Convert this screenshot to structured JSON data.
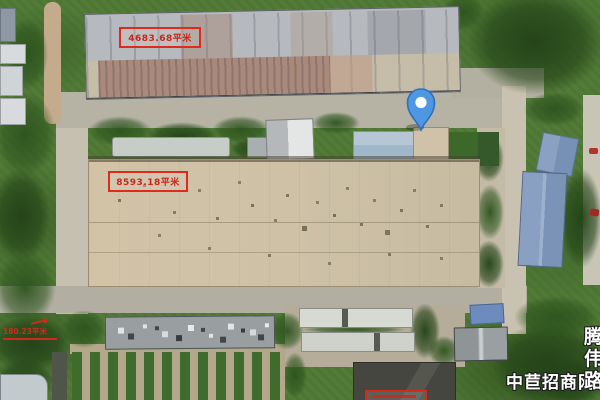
{
  "map": {
    "view": "satellite"
  },
  "annotations": {
    "top_label": {
      "text": "4683.68平米",
      "text_color": "#cf2418",
      "border_color": "#e02a1c"
    },
    "middle_label": {
      "text": "8593.18平米",
      "text_color": "#cf2418",
      "border_color": "#e02a1c"
    },
    "left_label": {
      "text": "180.23平米",
      "text_color": "#d3281c"
    }
  },
  "marker": {
    "type": "location-pin",
    "fill": "#4e97e3",
    "stroke": "#2f6fbd",
    "center_dot": "#ffffff"
  },
  "watermark": {
    "text": "中苣招商网",
    "color": "#ffffff",
    "outline": "#1d1d1d"
  },
  "vertical_road_label": {
    "text": "腾伟路",
    "color": "#ffffff",
    "outline": "#1d1d1d"
  }
}
